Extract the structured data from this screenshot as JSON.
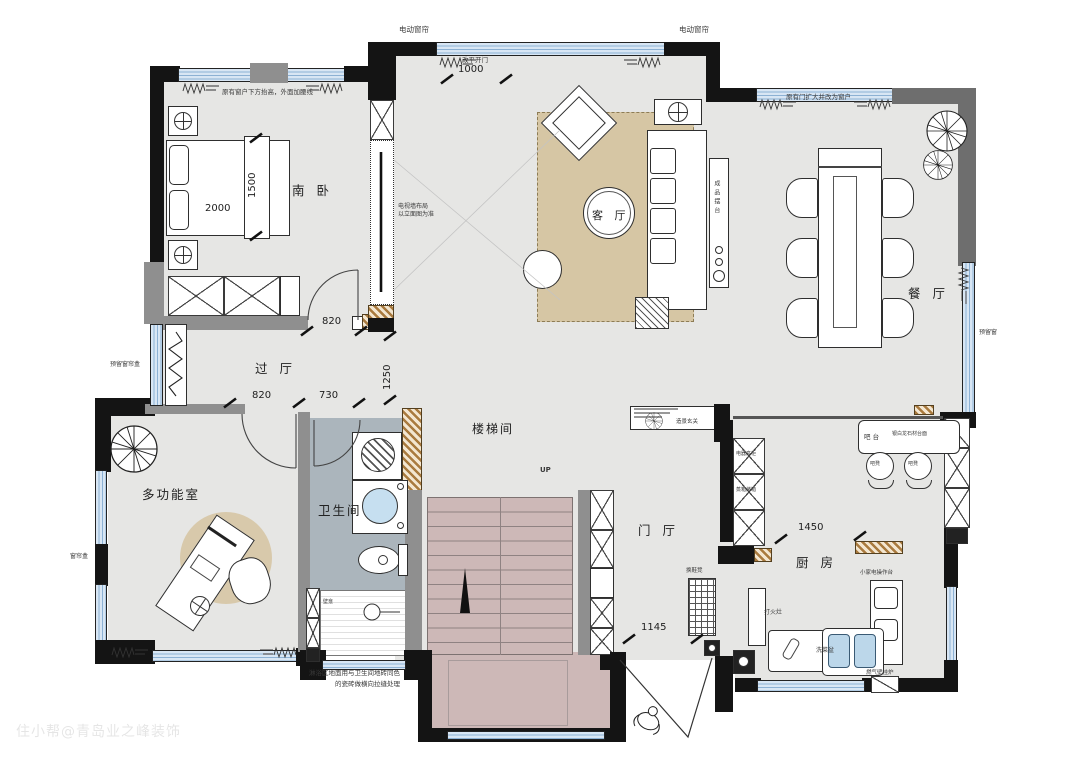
{
  "watermark": "住小帮@青岛业之峰装饰",
  "rooms": {
    "south_bedroom": "南 卧",
    "living": "客 厅",
    "dining": "餐 厅",
    "hall": "过 厅",
    "stairwell": "楼梯间",
    "foyer": "门 厅",
    "multi_room": "多功能室",
    "bathroom": "卫生间",
    "kitchen": "厨 房"
  },
  "dimensions": {
    "top_opening": "1000",
    "bedroom_door": "820",
    "hall_a": "820",
    "hall_b": "730",
    "hall_v": "1250",
    "foyer_entry": "1145",
    "kitchen_opening": "1450",
    "bed_width": "2000",
    "bed_depth": "1500"
  },
  "notes": {
    "curtain_top_left": "电动窗帘",
    "curtain_top_right": "电动窗帘",
    "door_change": "改平开门",
    "window_raise": "原有窗户下方抬高，外面加腰线",
    "door_to_window": "原有门扩大并改为窗户",
    "tv_wall_1": "电视墙布局",
    "tv_wall_2": "以立面图为准",
    "console": "成品摆台",
    "reserved_curtain_box": "预留窗帘盒",
    "curtain_box": "窗帘盒",
    "reserved_window": "预留窗",
    "up": "UP",
    "scenic_entry": "造景玄关",
    "shoe_bench": "换鞋凳",
    "bar_counter": "吧 台",
    "bar_material": "银白龙石材台面",
    "bar_stool_1": "吧凳",
    "bar_stool_2": "吧凳",
    "tall_cabinet": "电器高柜",
    "steam_oven": "蒸箱烤箱",
    "appliance_counter": "小家电操作台",
    "stove": "打火灶",
    "veg_sink": "洗菜盆",
    "boiler": "燃气壁挂炉",
    "niche": "壁龛",
    "shower_note_1": "淋浴区地面用与卫生间地砖同色",
    "shower_note_2": "的瓷砖做横向拉缝处理"
  },
  "colors": {
    "wall": "#141414",
    "gray_wall": "#8f8f8f",
    "dark_gray_wall": "#6e6e6e",
    "window": "#d8e6f4",
    "floor": "#e6e6e4",
    "rug": "#d6c6a4",
    "stairs": "#cdb8b7",
    "bath_floor": "#abb5bc",
    "hatch": "#a97a3e"
  }
}
